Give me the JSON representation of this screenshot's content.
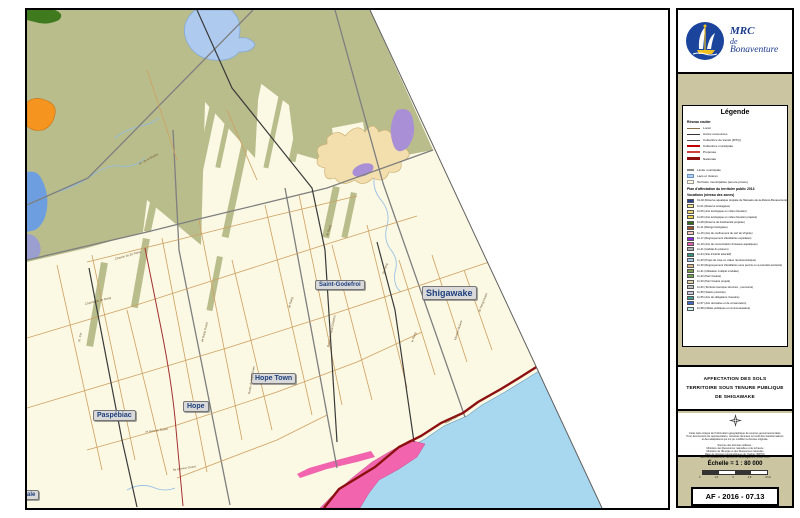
{
  "logo": {
    "line1": "MRC",
    "line2": "de",
    "line3": "Bonaventure"
  },
  "legend": {
    "title": "Légende",
    "roads_header": "Réseau routier",
    "road_items": [
      {
        "label": "Local",
        "swatch": "height:1px;background:#8C6D4A"
      },
      {
        "label": "Accès ressources",
        "swatch": "height:1px;background:#333333"
      },
      {
        "label": "Collectrice de transit (MTQ)",
        "swatch": "height:1px;background:#555555"
      },
      {
        "label": "Collectrice municipale",
        "swatch": "height:2px;background:#C00000"
      },
      {
        "label": "Proposée",
        "swatch": "height:2px;background:#D04040"
      },
      {
        "label": "Nationale",
        "swatch": "height:2.5px;background:#8C1010"
      }
    ],
    "area_items": [
      {
        "label": "Limite municipale",
        "kind": "line",
        "swatch": "height:1.5px;background:#8C8C8C"
      },
      {
        "label": "Lacs et rivières",
        "kind": "box",
        "swatch": "background:#AECBEF;border:0.5px solid #6A93C4"
      },
      {
        "label": "Territoire municipalisé (tenure privée)",
        "kind": "box",
        "swatch": "background:#FBF8E4;border:0.5px solid #999999"
      }
    ],
    "patp_header": "Plan d'affectation du territoire public 2013",
    "patp_subheader": "Vocations (niveau des zones)",
    "patp_items": [
      {
        "label": "01-02 (Réserve aquatique projetée de l'Estuaire-de-la-Rivière-Bonaventure)",
        "color": "#27408B"
      },
      {
        "label": "11-01 (Réserve écologique)",
        "color": "#F2E88F"
      },
      {
        "label": "11-05 (Aire écologique en milieu forestier)",
        "color": "#EDD96B"
      },
      {
        "label": "11-06 (Aire écologique en milieu forestier projetée)",
        "color": "#E7CF4F"
      },
      {
        "label": "11-08 (Réserve de biodiversité projetée)",
        "color": "#336B1E"
      },
      {
        "label": "11-11 (Refuge biologique)",
        "color": "#A0522D"
      },
      {
        "label": "11-15 (Aire de confinement du cerf de Virginie)",
        "color": "#F2C9C0"
      },
      {
        "label": "11-17 (Regroupement d'érablières exploitées)",
        "color": "#8A2BE2"
      },
      {
        "label": "11-19 (Aire de concentration d'oiseaux aquatiques)",
        "color": "#E75BB0"
      },
      {
        "label": "11-21 (Habitat du poisson)",
        "color": "#ADADAD"
      },
      {
        "label": "11-24 (Site d'intérêt éducatif)",
        "color": "#33907C"
      },
      {
        "label": "11-25 (Projet de mise en valeur récréotouristique)",
        "color": "#9EC7E8"
      },
      {
        "label": "11-30 (Regroupement d'érablières sous permis ou à potentiel acéricole)",
        "color": "#D9B98C"
      },
      {
        "label": "11-31 (Utilisation multiple modulée)",
        "color": "#7A9E48"
      },
      {
        "label": "11-32 (Parc linéaire)",
        "color": "#6FA34D"
      },
      {
        "label": "11-33 (Parc linéaire projeté)",
        "color": "#E2D3A8"
      },
      {
        "label": "11-52 (Territoire faunique structuré - pourvoirie)",
        "color": "#C0C0C0"
      },
      {
        "label": "11-55 (Station piscicole)",
        "color": "#C8C8DC"
      },
      {
        "label": "11-56 (Aire de villégiature riveraine)",
        "color": "#3F9E90"
      },
      {
        "label": "11-57 (Aire récréative et de conservation)",
        "color": "#4169C8"
      },
      {
        "label": "11-58 (Utilités publiques et communautaires)",
        "color": "#C5EDED"
      }
    ]
  },
  "title_block": {
    "line1": "AFFECTATION DES SOLS",
    "line2": "TERRITOIRE SOUS TENURE PUBLIQUE",
    "line3": "DE SHIGAWAKE"
  },
  "info_block": {
    "disclaimer": [
      "Cette carte intègre de l'information géographique de sources gouvernementales.",
      "Pour des besoins de représentation, certaines données ont subi des transformations",
      "et des adaptations qui ont pu modifier la donnée originale."
    ],
    "sources": [
      "Sources des données utilisées :",
      "Ministère des Ressources naturelles et de la Faune",
      "Ministère de l'Énergie et des Ressources naturelles",
      "Base de données topographiques du Québec (BDTQ)",
      "MRC de Bonaventure, Service de l'aménagement, février 2016"
    ]
  },
  "scale": {
    "label": "Échelle = 1 : 80 000",
    "ticks": [
      "0",
      "1,5",
      "3",
      "4,5",
      "6 km"
    ]
  },
  "ref": {
    "label": "AF - 2016 - 07.13"
  },
  "colors": {
    "public_land": "#B9BD8C",
    "private_land": "#FBF8E3",
    "sea": "#A8D7F0",
    "lake": "#AECBEF",
    "route_nationale": "#8C1010",
    "bird_area_pink": "#F265AE",
    "maple_zone_tan": "#F2DFAD",
    "purple_zone": "#A98FD5",
    "orange_zone": "#F5941E",
    "sidebar_bg": "#CBC5A1",
    "place_label_text": "#1D3F7E"
  },
  "map": {
    "place_labels": [
      {
        "text": "Paspébiac",
        "x": 66,
        "y": 400,
        "size": 7
      },
      {
        "text": "Hope",
        "x": 156,
        "y": 391,
        "size": 7
      },
      {
        "text": "Hope Town",
        "x": 224,
        "y": 363,
        "size": 7
      },
      {
        "text": "Saint-Godefroi",
        "x": 288,
        "y": 270,
        "size": 6
      },
      {
        "text": "Shigawake",
        "x": 395,
        "y": 276,
        "size": 9
      },
      {
        "text": "ale",
        "x": -4,
        "y": 480,
        "size": 6
      }
    ],
    "road_labels": [
      {
        "t": "4e Rang",
        "x": 300,
        "y": 224,
        "r": -73
      },
      {
        "t": "3e Rang",
        "x": 262,
        "y": 296,
        "r": -74
      },
      {
        "t": "2e Rang",
        "x": 356,
        "y": 262,
        "r": -70
      },
      {
        "t": "Route de Saint-Godefroi",
        "x": 301,
        "y": 335,
        "r": -78
      },
      {
        "t": "Route de Hope Town",
        "x": 222,
        "y": 382,
        "r": -80
      },
      {
        "t": "Chemin du 3e Rang",
        "x": 58,
        "y": 292,
        "r": -14
      },
      {
        "t": "Chemin du 2e Rang",
        "x": 88,
        "y": 247,
        "r": -16
      },
      {
        "t": "ch. de la Rivière",
        "x": 112,
        "y": 152,
        "r": -28
      },
      {
        "t": "Route 132",
        "x": 418,
        "y": 411,
        "r": -28
      },
      {
        "t": "7e Avenue Ouest",
        "x": 118,
        "y": 420,
        "r": -8
      },
      {
        "t": "5e Avenue Ouest",
        "x": 146,
        "y": 458,
        "r": -9
      },
      {
        "t": "le Rang",
        "x": 385,
        "y": 330,
        "r": -70
      },
      {
        "t": "Montée McGee",
        "x": 428,
        "y": 328,
        "r": -72
      },
      {
        "t": "ch. Cyr",
        "x": 52,
        "y": 330,
        "r": -80
      },
      {
        "t": "4e Rang Ouest",
        "x": 175,
        "y": 330,
        "r": -76
      },
      {
        "t": "2e Rang Ouest",
        "x": 452,
        "y": 300,
        "r": -68
      }
    ]
  }
}
